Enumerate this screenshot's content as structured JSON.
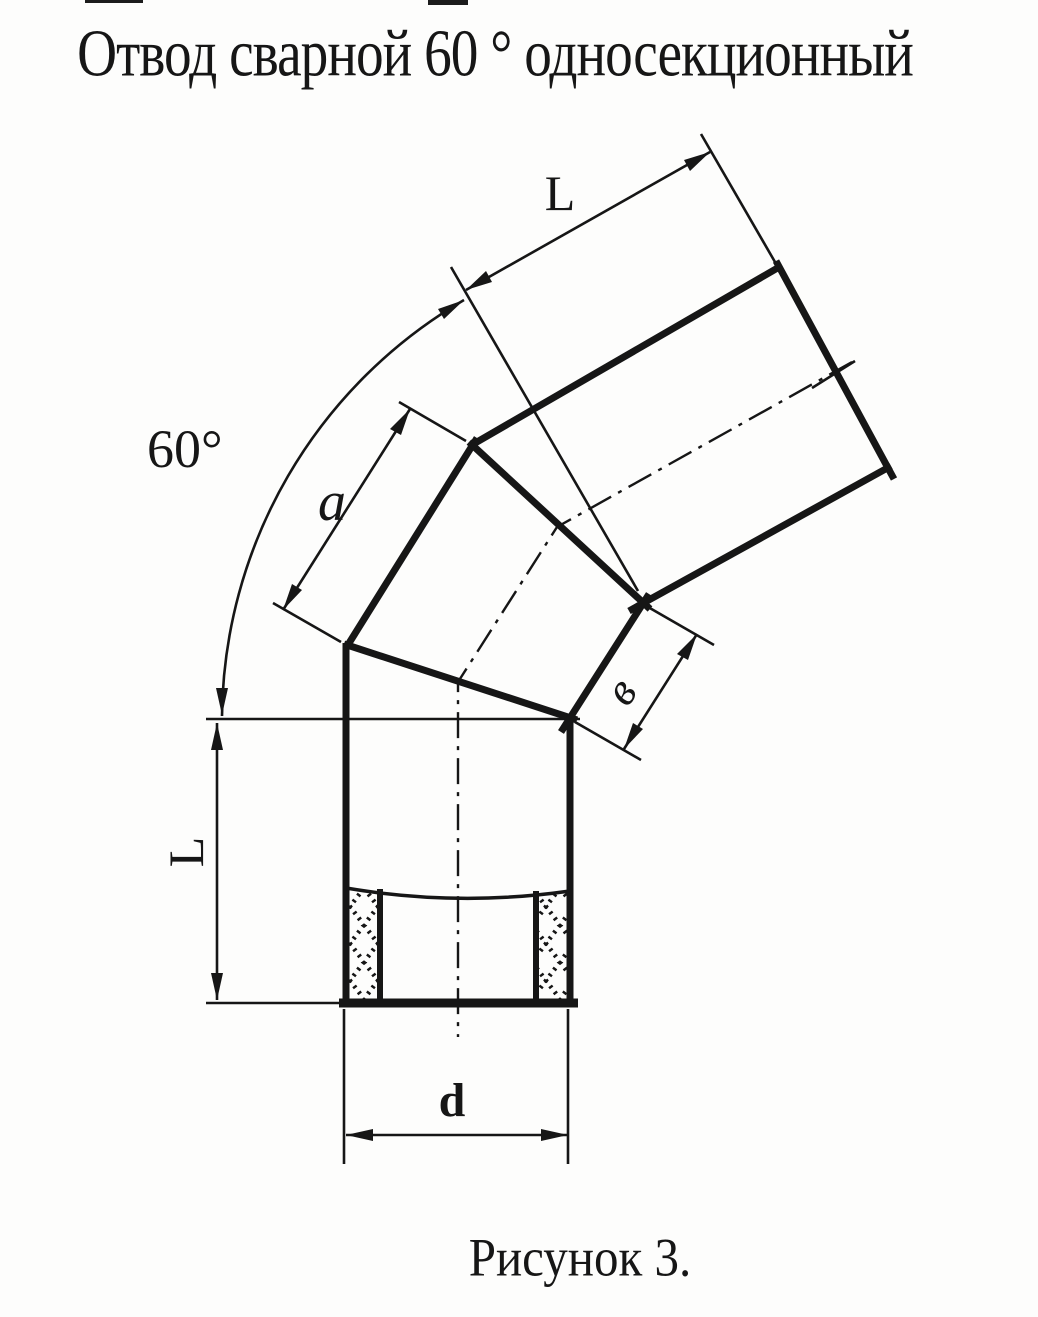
{
  "title": "Отвод сварной 60 ° односекционный",
  "caption": "Рисунок 3.",
  "labels": {
    "upper_length": "L",
    "bend_angle": "60°",
    "outer_side": "a",
    "inner_side": "в",
    "lower_length": "L",
    "diameter": "d"
  },
  "colors": {
    "ink": "#161616",
    "paper": "#fdfdfc"
  }
}
